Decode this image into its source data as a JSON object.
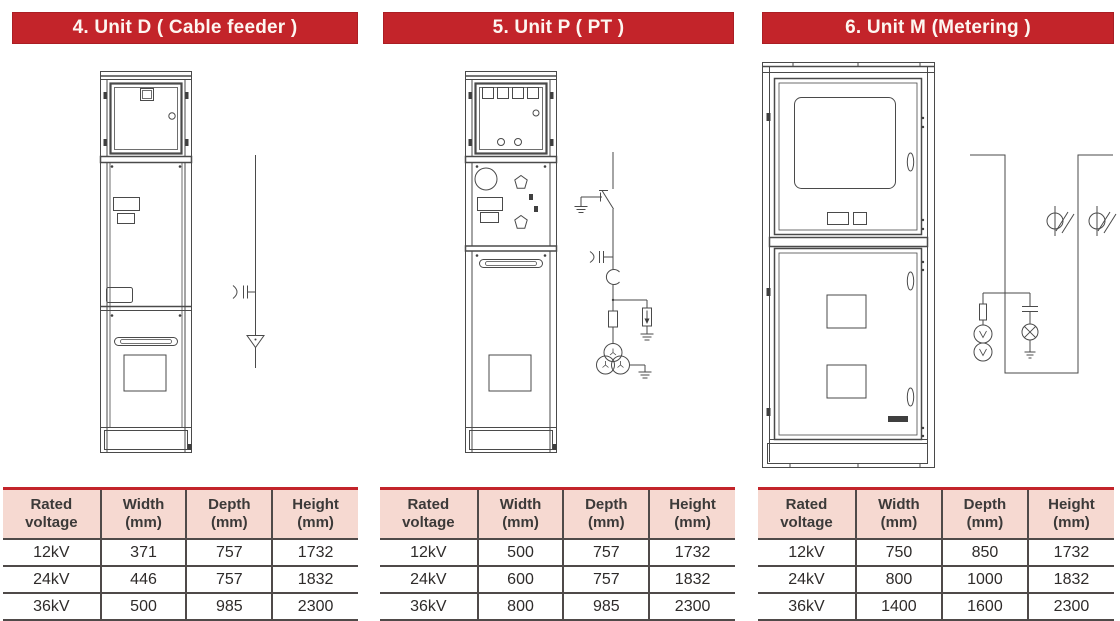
{
  "colors": {
    "banner_red": "#c3242a",
    "banner_border": "#aa1e24",
    "banner_text": "#fdf6f1",
    "table_header_bg": "#f6d9d1",
    "table_line": "#4f4a49",
    "table_text": "#2e2b2a",
    "drawing_line": "#4a4a4a"
  },
  "units": [
    {
      "id": "unit-d",
      "title": "4. Unit D ( Cable feeder )",
      "table": {
        "headers": [
          "Rated voltage",
          "Width (mm)",
          "Depth (mm)",
          "Height (mm)"
        ],
        "rows": [
          [
            "12kV",
            "371",
            "757",
            "1732"
          ],
          [
            "24kV",
            "446",
            "757",
            "1832"
          ],
          [
            "36kV",
            "500",
            "985",
            "2300"
          ]
        ]
      }
    },
    {
      "id": "unit-p",
      "title": "5. Unit P ( PT )",
      "table": {
        "headers": [
          "Rated voltage",
          "Width (mm)",
          "Depth (mm)",
          "Height (mm)"
        ],
        "rows": [
          [
            "12kV",
            "500",
            "757",
            "1732"
          ],
          [
            "24kV",
            "600",
            "757",
            "1832"
          ],
          [
            "36kV",
            "800",
            "985",
            "2300"
          ]
        ]
      }
    },
    {
      "id": "unit-m",
      "title": "6. Unit M (Metering )",
      "table": {
        "headers": [
          "Rated voltage",
          "Width (mm)",
          "Depth (mm)",
          "Height (mm)"
        ],
        "rows": [
          [
            "12kV",
            "750",
            "850",
            "1732"
          ],
          [
            "24kV",
            "800",
            "1000",
            "1832"
          ],
          [
            "36kV",
            "1400",
            "1600",
            "2300"
          ]
        ]
      }
    }
  ]
}
